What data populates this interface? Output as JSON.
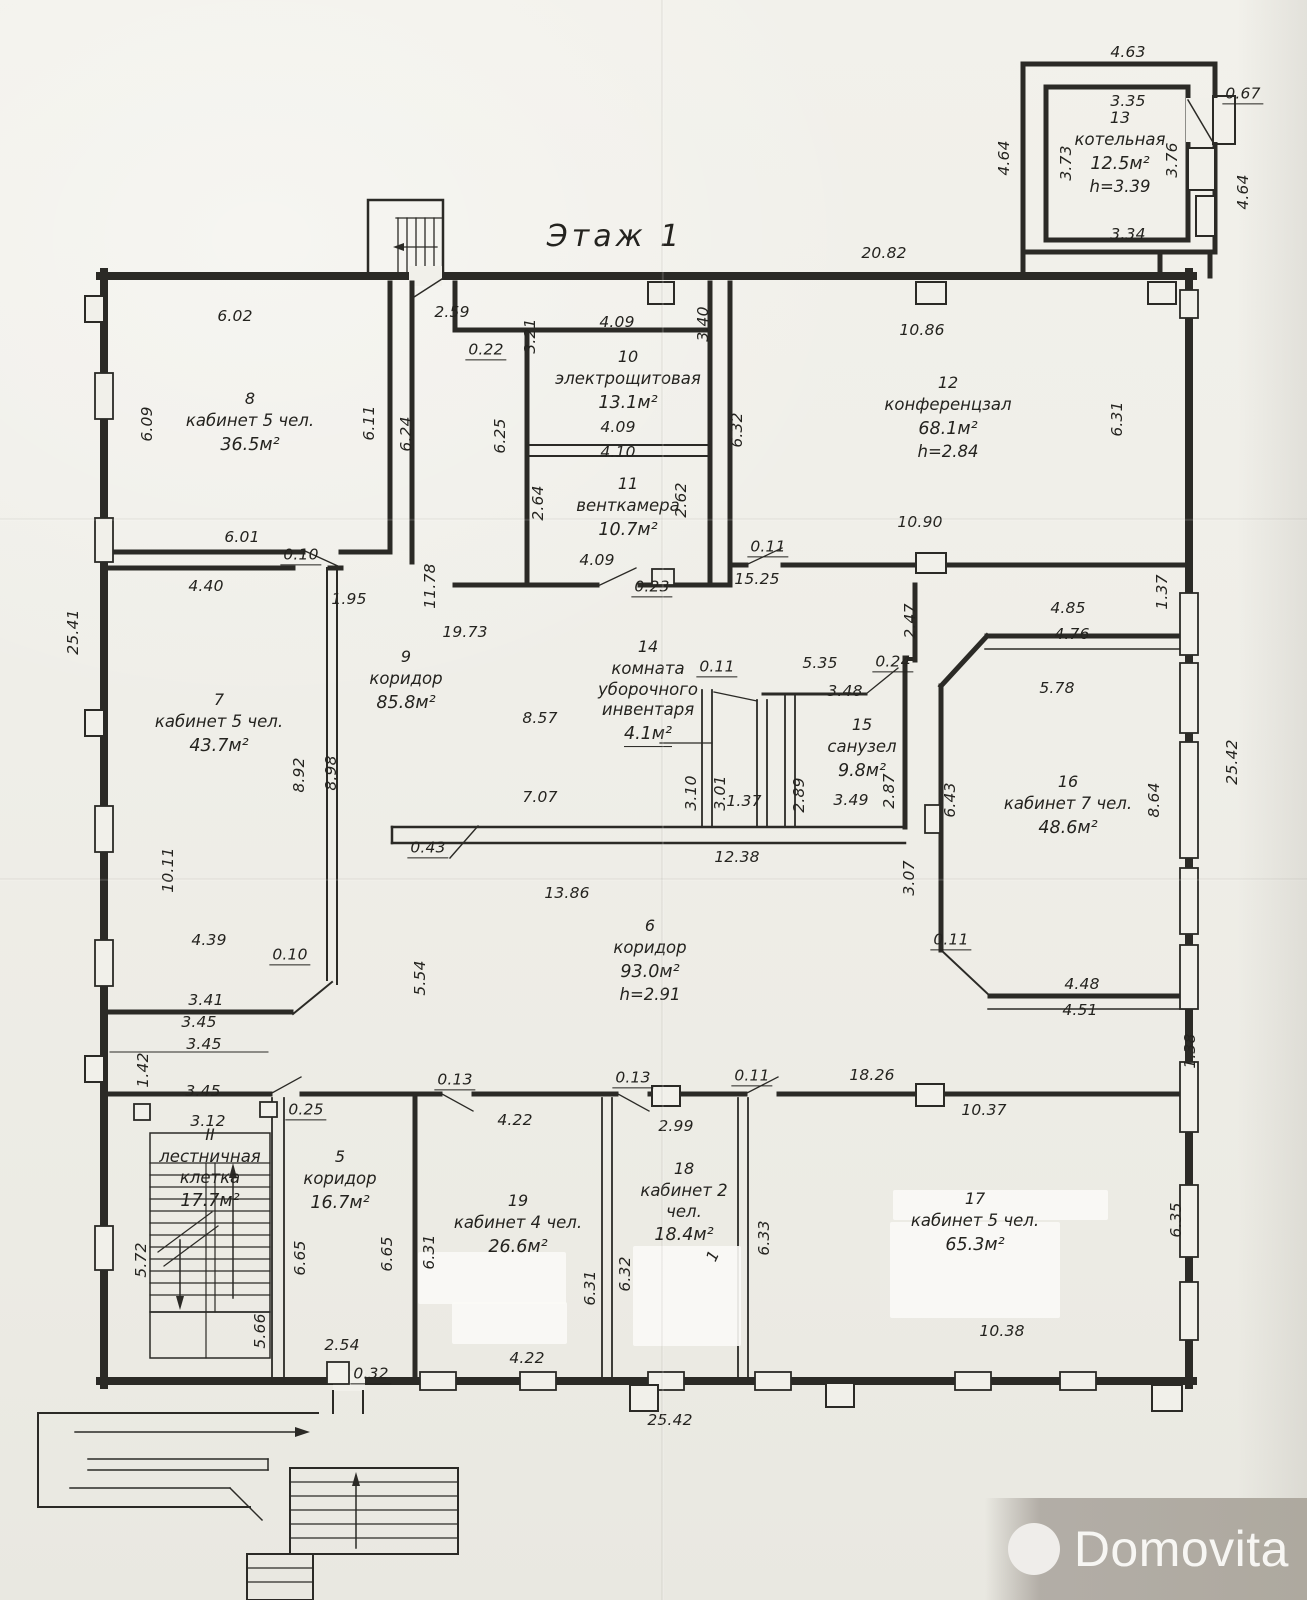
{
  "title": "Этаж 1",
  "watermark": {
    "brand": "Domovita"
  },
  "rooms": [
    {
      "num": "8",
      "name": "кабинет 5 чел.",
      "area": "36.5м²"
    },
    {
      "num": "7",
      "name": "кабинет 5 чел.",
      "area": "43.7м²"
    },
    {
      "num": "9",
      "name": "коридор",
      "area": "85.8м²"
    },
    {
      "num": "10",
      "name": "электрощитовая",
      "area": "13.1м²"
    },
    {
      "num": "11",
      "name": "венткамера",
      "area": "10.7м²"
    },
    {
      "num": "12",
      "name": "конференцзал",
      "area": "68.1м²",
      "h": "h=2.84"
    },
    {
      "num": "13",
      "name": "котельная",
      "area": "12.5м²",
      "h": "h=3.39"
    },
    {
      "num": "14",
      "name": "комната уборочного инвентаря",
      "area": "4.1м²"
    },
    {
      "num": "15",
      "name": "санузел",
      "area": "9.8м²"
    },
    {
      "num": "16",
      "name": "кабинет 7 чел.",
      "area": "48.6м²"
    },
    {
      "num": "6",
      "name": "коридор",
      "area": "93.0м²",
      "h": "h=2.91"
    },
    {
      "num": "II",
      "name": "лестничная клетка",
      "area": "17.7м²"
    },
    {
      "num": "5",
      "name": "коридор",
      "area": "16.7м²"
    },
    {
      "num": "19",
      "name": "кабинет 4 чел.",
      "area": "26.6м²"
    },
    {
      "num": "18",
      "name": "кабинет 2 чел.",
      "area": "18.4м²"
    },
    {
      "num": "17",
      "name": "кабинет 5 чел.",
      "area": "65.3м²"
    }
  ],
  "dimensions": [
    {
      "t": "4.63",
      "x": 1128,
      "y": 52
    },
    {
      "t": "3.35",
      "x": 1128,
      "y": 101
    },
    {
      "t": "0.67",
      "x": 1243,
      "y": 95,
      "u": 1
    },
    {
      "t": "4.64",
      "x": 1004,
      "y": 158,
      "r": -90
    },
    {
      "t": "3.73",
      "x": 1066,
      "y": 163,
      "r": -90
    },
    {
      "t": "3.76",
      "x": 1172,
      "y": 160,
      "r": -90
    },
    {
      "t": "4.64",
      "x": 1243,
      "y": 192,
      "r": -90
    },
    {
      "t": "3.34",
      "x": 1128,
      "y": 234
    },
    {
      "t": "20.82",
      "x": 884,
      "y": 253
    },
    {
      "t": "2.59",
      "x": 452,
      "y": 312
    },
    {
      "t": "0.22",
      "x": 486,
      "y": 351,
      "u": 1
    },
    {
      "t": "3.21",
      "x": 530,
      "y": 336,
      "r": -90
    },
    {
      "t": "6.02",
      "x": 235,
      "y": 316
    },
    {
      "t": "6.09",
      "x": 147,
      "y": 424,
      "r": -90
    },
    {
      "t": "6.11",
      "x": 369,
      "y": 423,
      "r": -90
    },
    {
      "t": "6.24",
      "x": 406,
      "y": 434,
      "r": -90
    },
    {
      "t": "6.01",
      "x": 242,
      "y": 537
    },
    {
      "t": "0.10",
      "x": 301,
      "y": 556,
      "u": 1
    },
    {
      "t": "4.40",
      "x": 206,
      "y": 586
    },
    {
      "t": "1.95",
      "x": 349,
      "y": 599
    },
    {
      "t": "4.09",
      "x": 617,
      "y": 322
    },
    {
      "t": "3.40",
      "x": 703,
      "y": 324,
      "r": -90
    },
    {
      "t": "10.86",
      "x": 922,
      "y": 330
    },
    {
      "t": "6.25",
      "x": 500,
      "y": 436,
      "r": -90
    },
    {
      "t": "4.09",
      "x": 618,
      "y": 427
    },
    {
      "t": "4.10",
      "x": 618,
      "y": 452
    },
    {
      "t": "2.64",
      "x": 538,
      "y": 503,
      "r": -90
    },
    {
      "t": "2.62",
      "x": 681,
      "y": 500,
      "r": -90
    },
    {
      "t": "6.32",
      "x": 737,
      "y": 430,
      "r": -90
    },
    {
      "t": "6.31",
      "x": 1117,
      "y": 419,
      "r": -90
    },
    {
      "t": "10.90",
      "x": 920,
      "y": 522
    },
    {
      "t": "4.09",
      "x": 597,
      "y": 560
    },
    {
      "t": "0.23",
      "x": 652,
      "y": 588,
      "u": 1
    },
    {
      "t": "0.11",
      "x": 768,
      "y": 548,
      "u": 1
    },
    {
      "t": "15.25",
      "x": 757,
      "y": 579
    },
    {
      "t": "11.78",
      "x": 430,
      "y": 586,
      "r": -90
    },
    {
      "t": "19.73",
      "x": 465,
      "y": 632
    },
    {
      "t": "25.41",
      "x": 73,
      "y": 632,
      "r": -90
    },
    {
      "t": "1.37",
      "x": 1162,
      "y": 592,
      "r": -90
    },
    {
      "t": "2.47",
      "x": 910,
      "y": 621,
      "r": -90
    },
    {
      "t": "4.85",
      "x": 1068,
      "y": 608
    },
    {
      "t": "4.76",
      "x": 1072,
      "y": 634
    },
    {
      "t": "5.78",
      "x": 1057,
      "y": 688
    },
    {
      "t": "8.57",
      "x": 540,
      "y": 718
    },
    {
      "t": "0.11",
      "x": 717,
      "y": 668,
      "u": 1
    },
    {
      "t": "5.35",
      "x": 820,
      "y": 663
    },
    {
      "t": "0.24",
      "x": 893,
      "y": 663,
      "u": 1
    },
    {
      "t": "3.48",
      "x": 845,
      "y": 691
    },
    {
      "t": "8.92",
      "x": 299,
      "y": 775,
      "r": -90
    },
    {
      "t": "8.98",
      "x": 331,
      "y": 773,
      "r": -90
    },
    {
      "t": "3.10",
      "x": 691,
      "y": 793,
      "r": -90
    },
    {
      "t": "3.01",
      "x": 720,
      "y": 793,
      "r": -90
    },
    {
      "t": "1.37",
      "x": 744,
      "y": 801
    },
    {
      "t": "2.89",
      "x": 799,
      "y": 795,
      "r": -90
    },
    {
      "t": "3.49",
      "x": 851,
      "y": 800
    },
    {
      "t": "2.87",
      "x": 889,
      "y": 791,
      "r": -90
    },
    {
      "t": "6.43",
      "x": 950,
      "y": 800,
      "r": -90
    },
    {
      "t": "8.64",
      "x": 1154,
      "y": 800,
      "r": -90
    },
    {
      "t": "25.42",
      "x": 1232,
      "y": 762,
      "r": -90
    },
    {
      "t": "7.07",
      "x": 540,
      "y": 797
    },
    {
      "t": "0.43",
      "x": 428,
      "y": 849,
      "u": 1
    },
    {
      "t": "12.38",
      "x": 737,
      "y": 857
    },
    {
      "t": "13.86",
      "x": 567,
      "y": 893
    },
    {
      "t": "10.11",
      "x": 168,
      "y": 870,
      "r": -90
    },
    {
      "t": "3.07",
      "x": 909,
      "y": 878,
      "r": -90
    },
    {
      "t": "0.11",
      "x": 951,
      "y": 941,
      "u": 1
    },
    {
      "t": "4.39",
      "x": 209,
      "y": 940
    },
    {
      "t": "0.10",
      "x": 290,
      "y": 956,
      "u": 1
    },
    {
      "t": "5.54",
      "x": 420,
      "y": 978,
      "r": -90
    },
    {
      "t": "4.48",
      "x": 1082,
      "y": 984
    },
    {
      "t": "4.51",
      "x": 1080,
      "y": 1010
    },
    {
      "t": "3.41",
      "x": 206,
      "y": 1000
    },
    {
      "t": "3.45",
      "x": 199,
      "y": 1022
    },
    {
      "t": "1.38",
      "x": 1190,
      "y": 1051,
      "r": -90
    },
    {
      "t": "3.45",
      "x": 204,
      "y": 1044
    },
    {
      "t": "1.42",
      "x": 143,
      "y": 1070,
      "r": -90
    },
    {
      "t": "3.45",
      "x": 203,
      "y": 1091
    },
    {
      "t": "3.12",
      "x": 208,
      "y": 1121
    },
    {
      "t": "0.25",
      "x": 306,
      "y": 1111,
      "u": 1
    },
    {
      "t": "0.13",
      "x": 455,
      "y": 1081,
      "u": 1
    },
    {
      "t": "0.13",
      "x": 633,
      "y": 1079,
      "u": 1
    },
    {
      "t": "0.11",
      "x": 752,
      "y": 1077,
      "u": 1
    },
    {
      "t": "18.26",
      "x": 872,
      "y": 1075
    },
    {
      "t": "4.22",
      "x": 515,
      "y": 1120
    },
    {
      "t": "2.99",
      "x": 676,
      "y": 1126
    },
    {
      "t": "10.37",
      "x": 984,
      "y": 1110
    },
    {
      "t": "5.72",
      "x": 141,
      "y": 1260,
      "r": -90
    },
    {
      "t": "5.66",
      "x": 260,
      "y": 1331,
      "r": -90
    },
    {
      "t": "6.65",
      "x": 300,
      "y": 1258,
      "r": -90
    },
    {
      "t": "6.65",
      "x": 387,
      "y": 1254,
      "r": -90
    },
    {
      "t": "6.31",
      "x": 429,
      "y": 1252,
      "r": -90
    },
    {
      "t": "6.31",
      "x": 590,
      "y": 1288,
      "r": -90
    },
    {
      "t": "6.32",
      "x": 625,
      "y": 1274,
      "r": -90
    },
    {
      "t": "6.33",
      "x": 764,
      "y": 1238,
      "r": -90
    },
    {
      "t": "6.35",
      "x": 1176,
      "y": 1220,
      "r": -90
    },
    {
      "t": "1",
      "x": 713,
      "y": 1256,
      "r": -65
    },
    {
      "t": "2.54",
      "x": 342,
      "y": 1345
    },
    {
      "t": "0.32",
      "x": 371,
      "y": 1375,
      "u": 1
    },
    {
      "t": "4.22",
      "x": 527,
      "y": 1358
    },
    {
      "t": "10.38",
      "x": 1002,
      "y": 1331
    },
    {
      "t": "25.42",
      "x": 670,
      "y": 1420
    }
  ]
}
